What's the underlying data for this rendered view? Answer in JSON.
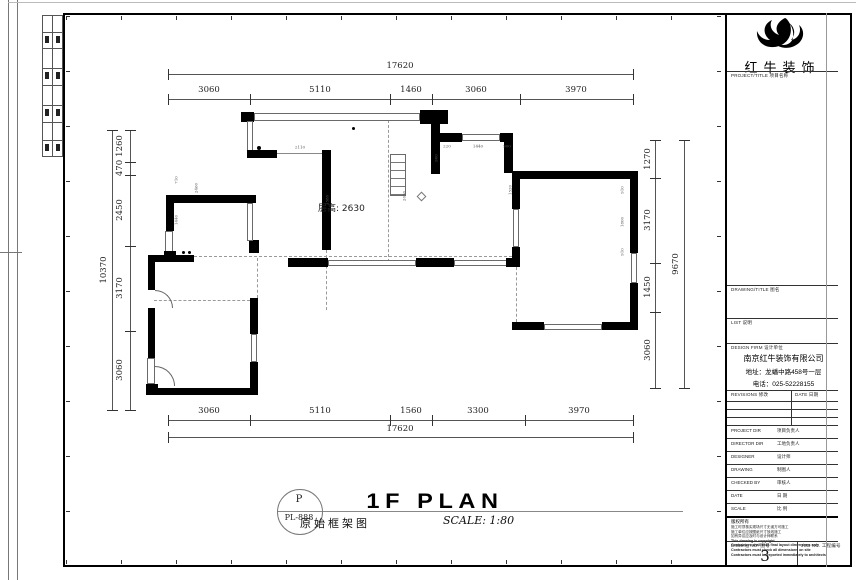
{
  "sheet": {
    "plan": {
      "floor_height_note": "层高: 2630",
      "dims": {
        "top_total": "17620",
        "top_segments": [
          "3060",
          "5110",
          "1460",
          "3060",
          "3970"
        ],
        "bottom_segments": [
          "3060",
          "5110",
          "1560",
          "3300",
          "3970"
        ],
        "bottom_total": "17620",
        "left_segments": [
          "1260",
          "470",
          "2450",
          "3170",
          "3060"
        ],
        "left_total": "10370",
        "right_segments": [
          "1270",
          "3170",
          "1450",
          "3060"
        ],
        "right_total": "9670"
      },
      "dim_labels": [
        {
          "t": "17620",
          "x": 400,
          "y": 66
        },
        {
          "t": "3060",
          "x": 209,
          "y": 90
        },
        {
          "t": "5110",
          "x": 320,
          "y": 90
        },
        {
          "t": "1460",
          "x": 411,
          "y": 90
        },
        {
          "t": "3060",
          "x": 476,
          "y": 90
        },
        {
          "t": "3970",
          "x": 576,
          "y": 90
        },
        {
          "t": "3060",
          "x": 209,
          "y": 411
        },
        {
          "t": "5110",
          "x": 320,
          "y": 411
        },
        {
          "t": "1560",
          "x": 411,
          "y": 411
        },
        {
          "t": "3300",
          "x": 478,
          "y": 411
        },
        {
          "t": "3970",
          "x": 579,
          "y": 411
        },
        {
          "t": "17620",
          "x": 400,
          "y": 429
        },
        {
          "t": "10370",
          "x": 104,
          "y": 270,
          "v": 1
        },
        {
          "t": "1260",
          "x": 120,
          "y": 146,
          "v": 1
        },
        {
          "t": "470",
          "x": 120,
          "y": 168,
          "v": 1
        },
        {
          "t": "2450",
          "x": 120,
          "y": 210,
          "v": 1
        },
        {
          "t": "3170",
          "x": 120,
          "y": 288,
          "v": 1
        },
        {
          "t": "3060",
          "x": 120,
          "y": 370,
          "v": 1
        },
        {
          "t": "9670",
          "x": 676,
          "y": 264,
          "v": 1
        },
        {
          "t": "1270",
          "x": 648,
          "y": 159,
          "v": 1
        },
        {
          "t": "3170",
          "x": 648,
          "y": 220,
          "v": 1
        },
        {
          "t": "1450",
          "x": 648,
          "y": 287,
          "v": 1
        },
        {
          "t": "3060",
          "x": 648,
          "y": 350,
          "v": 1
        },
        {
          "t": "2110",
          "x": 300,
          "y": 147,
          "s": 1
        },
        {
          "t": "220",
          "x": 447,
          "y": 146,
          "s": 1
        },
        {
          "t": "1440",
          "x": 478,
          "y": 146,
          "s": 1
        },
        {
          "t": "900",
          "x": 507,
          "y": 146,
          "s": 1
        },
        {
          "t": "900",
          "x": 436,
          "y": 158,
          "v": 1,
          "s": 1
        },
        {
          "t": "1520",
          "x": 510,
          "y": 190,
          "v": 1,
          "s": 1
        },
        {
          "t": "2630",
          "x": 404,
          "y": 196,
          "v": 1,
          "s": 1
        },
        {
          "t": "910",
          "x": 622,
          "y": 190,
          "v": 1,
          "s": 1
        },
        {
          "t": "1800",
          "x": 622,
          "y": 222,
          "v": 1,
          "s": 1
        },
        {
          "t": "910",
          "x": 622,
          "y": 252,
          "v": 1,
          "s": 1
        },
        {
          "t": "710",
          "x": 176,
          "y": 180,
          "v": 1,
          "s": 1
        },
        {
          "t": "1440",
          "x": 176,
          "y": 220,
          "v": 1,
          "s": 1
        },
        {
          "t": "2460",
          "x": 196,
          "y": 188,
          "v": 1,
          "s": 1
        },
        {
          "t": "1580",
          "x": 327,
          "y": 200,
          "v": 1,
          "s": 1
        }
      ]
    },
    "title_area": {
      "plan_code_letter": "P",
      "plan_code": "PL-888",
      "plan_title_en": "1F PLAN",
      "plan_title_cn": "原始框架图",
      "scale_label": "SCALE: 1:80"
    },
    "title_block": {
      "logo_text": "红牛装饰",
      "project_title_label": "PROJECT/TITLE  项目名称",
      "drawing_title_label": "DRAWING/TITLE  图名",
      "list_label": "LIST  说明",
      "design_firm_label": "DESIGN FIRM  设计单位",
      "firm_name": "南京红牛装饰有限公司",
      "firm_address": "地址：龙蟠中路458号一层",
      "firm_phone": "电话：025-52228155",
      "revisions_label": "REVISIONS  修改",
      "date_col_label": "DATE  日期",
      "rows": [
        {
          "en": "PROJECT DIR",
          "cn": "项目负责人"
        },
        {
          "en": "DIRECTOR DIR",
          "cn": "工地负责人"
        },
        {
          "en": "DESIGNER",
          "cn": "设计师"
        },
        {
          "en": "DRAWING",
          "cn": "制图人"
        },
        {
          "en": "CHECKED BY",
          "cn": "审核人"
        },
        {
          "en": "DATE",
          "cn": "日  期"
        },
        {
          "en": "SCALE",
          "cn": "比  例"
        }
      ],
      "notes_title": "版权所有",
      "notes": [
        "施工时须核实现场尺寸无误方可施工",
        "施工单位应按图纸尺寸放线施工",
        "如有异议应及时与设计师联系",
        "This drawing is copyright",
        "Contractors shall seek final layout dimensions only",
        "Contractors must check all dimensions on site",
        "Contractors must be reported immediately to architects"
      ],
      "drawing_no_label": "Drawing NO.  图号",
      "drawing_no": "3",
      "job_no_label": "JOB NO.  工程编号"
    }
  }
}
